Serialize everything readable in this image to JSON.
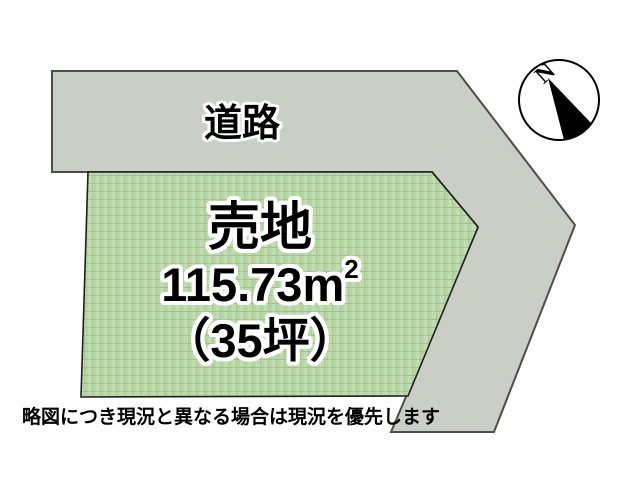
{
  "diagram": {
    "road": {
      "label": "道路"
    },
    "plot": {
      "title": "売地",
      "area_value": "115.73",
      "area_unit": "m",
      "area_exponent": "2",
      "tsubo": "（35坪）"
    },
    "compass": {
      "north_label": "N"
    },
    "caption": "略図につき現況と異なる場合は現況を優先します"
  },
  "colors": {
    "road_fill": "#c9cec7",
    "road_stroke": "#4d4d4d",
    "plot_fill": "#b6d6a4",
    "plot_stroke": "#1f1f1f",
    "compass_fill": "#ffffff",
    "compass_stroke": "#000000",
    "needle_fill": "#000000",
    "text_color": "#000000",
    "text_outline": "#ffffff"
  }
}
